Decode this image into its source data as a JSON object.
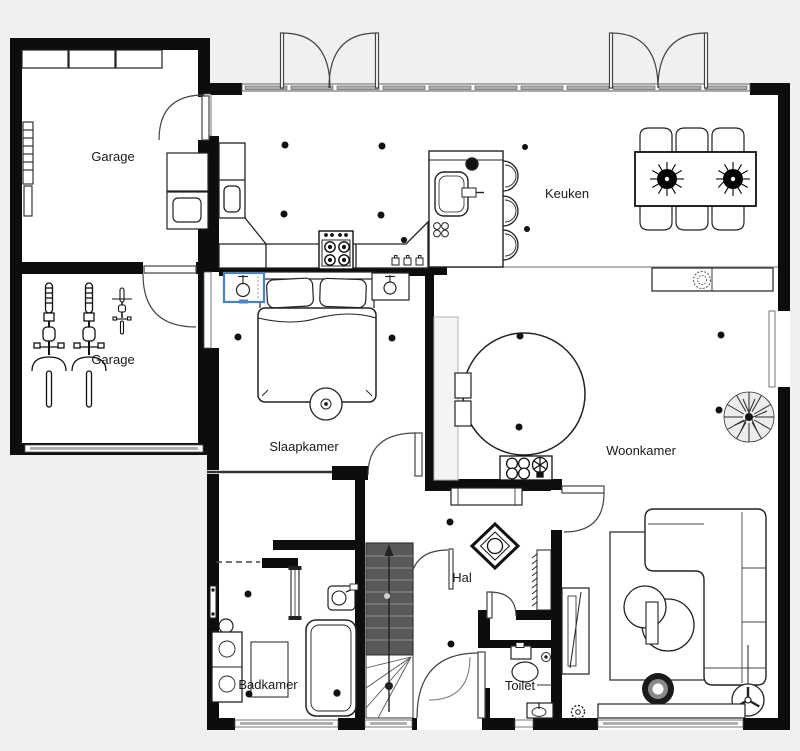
{
  "title": "Floor plan",
  "rooms": {
    "garage_top": "Garage",
    "garage_bottom": "Garage",
    "keuken": "Keuken",
    "slaapkamer": "Slaapkamer",
    "woonkamer": "Woonkamer",
    "hal": "Hal",
    "badkamer": "Badkamer",
    "toilet": "Toilet"
  },
  "colors": {
    "background": "#f2f0ee",
    "floor": "#ffffff",
    "wall": "#0d0d0d",
    "window_frame": "#9a9a9a",
    "selection_highlight": "#4a82c4",
    "stairs_fill": "#595959"
  },
  "furniture_names": [
    "wall-shelves",
    "ladder",
    "storage-cabinets",
    "bicycle",
    "bicycle",
    "child-bicycle",
    "kitchen-counter",
    "stove",
    "kitchen-island-with-sink",
    "bar-stools",
    "dining-table",
    "dining-chairs",
    "table-centerpieces",
    "sideboard",
    "potted-plant",
    "round-rug",
    "wall-speakers",
    "side-table",
    "corner-sofa",
    "rug",
    "lounge-chair",
    "pouf",
    "ceiling-fan",
    "tv-lowboard",
    "tv-cabinet",
    "radiator",
    "double-bed",
    "nightstand-selected",
    "nightstand",
    "stool",
    "stairs",
    "diamond-ornament",
    "hall-sideboard",
    "washing-machine",
    "bathtub",
    "bath-mat",
    "wall-sink",
    "towel-radiator",
    "shower-rail",
    "toilet-wc",
    "toilet-sink",
    "ceiling-light"
  ]
}
